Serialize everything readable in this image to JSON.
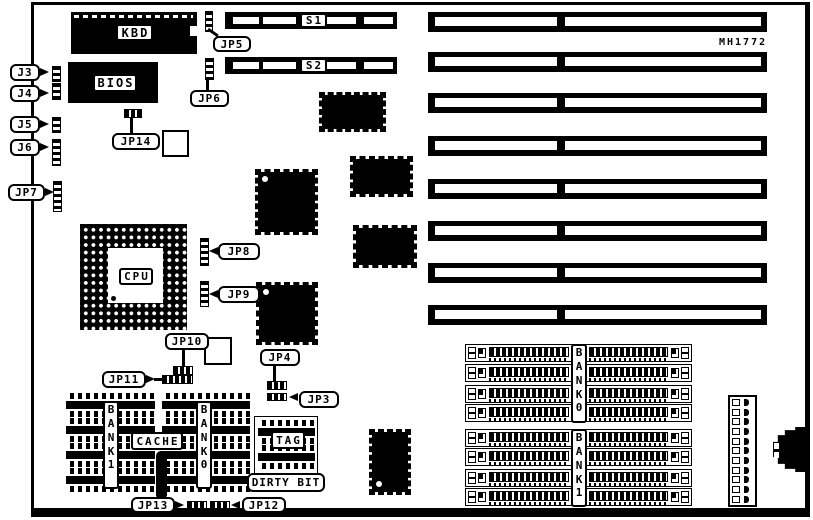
{
  "board": {
    "marking": "MH1772"
  },
  "labels": {
    "kbd": "KBD",
    "bios": "BIOS",
    "s1": "S1",
    "s2": "S2",
    "cpu": "CPU",
    "cache": "CACHE",
    "tag": "TAG",
    "dirty_bit": "DIRTY BIT",
    "cache_bank_left": "BANK1",
    "cache_bank_right": "BANK0",
    "simm_bank_top": "BANK0",
    "simm_bank_bottom": "BANK1"
  },
  "callouts": {
    "j3": "J3",
    "j4": "J4",
    "j5": "J5",
    "j6": "J6",
    "jp7": "JP7",
    "jp5": "JP5",
    "jp6": "JP6",
    "jp14": "JP14",
    "jp8": "JP8",
    "jp9": "JP9",
    "jp10": "JP10",
    "jp11": "JP11",
    "jp4": "JP4",
    "jp3": "JP3",
    "jp13": "JP13",
    "jp12": "JP12"
  },
  "counts": {
    "isa_slots": 8,
    "simm_rows_per_bank": 4,
    "cache_chips_per_bank": 4,
    "tag_chips": 2,
    "power_connector_pins": 11,
    "qfp_chips": 6
  },
  "colors": {
    "ink": "#000000",
    "background": "#ffffff"
  }
}
